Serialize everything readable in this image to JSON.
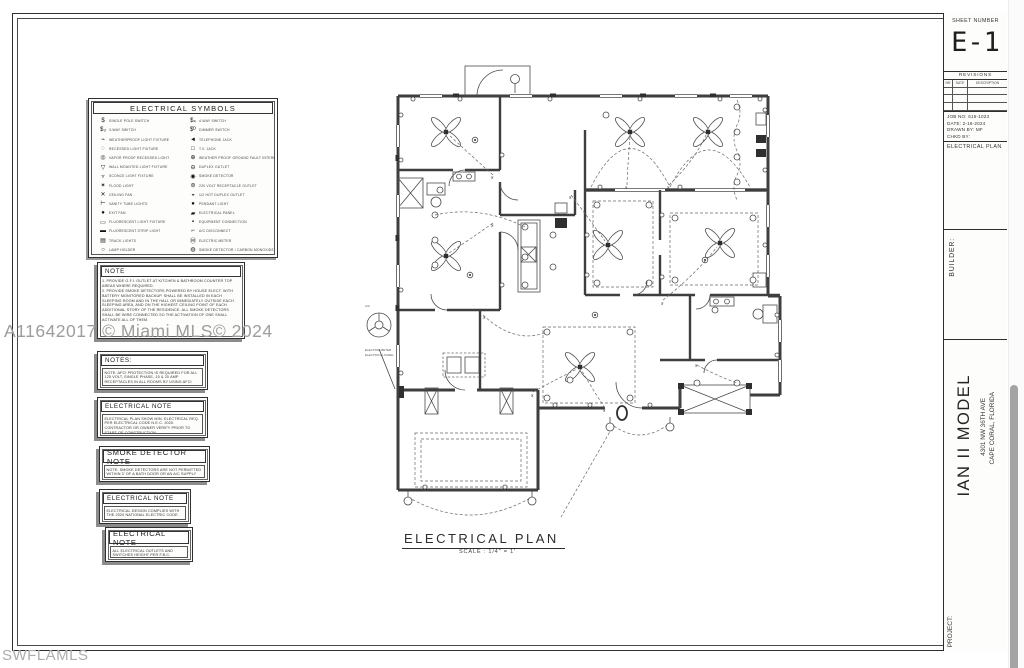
{
  "watermarks": {
    "mls_id": "A11642017 © Miami MLS© 2024",
    "swfl": "SWFLAMLS"
  },
  "legend": {
    "title": "ELECTRICAL SYMBOLS",
    "left": [
      {
        "glyph": "$",
        "label": "SINGLE POLE SWITCH"
      },
      {
        "glyph": "$₃",
        "label": "3-WAY SWITCH"
      },
      {
        "glyph": "⌁",
        "label": "WEATHERPROOF LIGHT FIXTURE"
      },
      {
        "glyph": "◌",
        "label": "RECESSED LIGHT FIXTURE"
      },
      {
        "glyph": "◎",
        "label": "VAPOR PROOF RECESSED LIGHT"
      },
      {
        "glyph": "▽",
        "label": "WALL MOUNTED LIGHT FIXTURE"
      },
      {
        "glyph": "▿",
        "label": "SCONCE LIGHT FIXTURE"
      },
      {
        "glyph": "✶",
        "label": "FLOOD LIGHT"
      },
      {
        "glyph": "✕",
        "label": "CEILING FAN"
      },
      {
        "glyph": "⊢",
        "label": "VANITY TUBE LIGHTS"
      },
      {
        "glyph": "●",
        "label": "EXIT FAN"
      },
      {
        "glyph": "▭",
        "label": "FLUORESCENT LIGHT FIXTURE"
      },
      {
        "glyph": "▬",
        "label": "FLUORESCENT STRIP LIGHT"
      },
      {
        "glyph": "▤",
        "label": "TRACK LIGHTS"
      },
      {
        "glyph": "○",
        "label": "LAMP HOLDER"
      }
    ],
    "right": [
      {
        "glyph": "$₄",
        "label": "4-WAY SWITCH"
      },
      {
        "glyph": "$ᴰ",
        "label": "DIMMER SWITCH"
      },
      {
        "glyph": "◄",
        "label": "TELEPHONE JACK"
      },
      {
        "glyph": "□",
        "label": "T.V. JACK"
      },
      {
        "glyph": "⊕",
        "label": "WEATHER PROOF GROUND FAULT INTERRUPT"
      },
      {
        "glyph": "⊖",
        "label": "DUPLEX OUTLET"
      },
      {
        "glyph": "◉",
        "label": "SMOKE DETECTOR"
      },
      {
        "glyph": "⊜",
        "label": "220 VOLT RECEPTACLE OUTLET"
      },
      {
        "glyph": "◒",
        "label": "1/2 HOT DUPLEX OUTLET"
      },
      {
        "glyph": "●",
        "label": "PENDANT LIGHT"
      },
      {
        "glyph": "▰",
        "label": "ELECTRICAL PANEL"
      },
      {
        "glyph": "▪",
        "label": "EQUIPMENT CONNECTION"
      },
      {
        "glyph": "⌐",
        "label": "A/C DISCONNECT"
      },
      {
        "glyph": "Ⓜ",
        "label": "ELECTRIC METER"
      },
      {
        "glyph": "◍",
        "label": "SMOKE DETECTOR / CARBON MONOXIDE COMBO"
      }
    ]
  },
  "notes": [
    {
      "title": "NOTE",
      "body": "1.  PROVIDE G.F.I. OUTLET AT KITCHEN & BATHROOM COUNTER TOP AREAS WHERE REQUIRED.\n2.  PROVIDE SMOKE DETECTORS POWERED BY HOUSE ELECT. WITH BATTERY MONITORED BACKUP. SHALL BE INSTALLED IN EACH SLEEPING ROOM AND IN THE HALL OR IMMEDIATELY OUTSIDE EACH SLEEPING AREA, AND ON THE HIGHEST CEILING POINT OF EACH ADDITIONAL STORY OF THE RESIDENCE. ALL SMOKE DETECTORS SHALL BE WIRE CONNECTED SO THE ACTIVATION OF ONE SHALL ACTIVATE ALL OF THEM."
    },
    {
      "title": "NOTES:",
      "body": "NOTE: AFCI PROTECTION IS REQUIRED FOR ALL 125 VOLT, SINGLE PHASE, 15 & 20 AMP RECEPTACLES IN ALL ROOMS BY USING AFCI CIRCUIT BREAKERS OR AFCI RECEPTACLES."
    },
    {
      "title": "ELECTRICAL NOTE",
      "body": "ELECTRICAL PLAN SHOW MIN. ELECTRICAL REQ. PER ELECTRICAL CODE N.E.C. 2020. CONTRACTOR OR OWNER VERIFY PRIOR TO START OF CONSTRUCTION."
    },
    {
      "title": "SMOKE DETECTOR NOTE",
      "body": "NOTE: SMOKE DETECTORS ARE NOT PERMITTED WITHIN 3' OF A BATH DOOR OR AN A/C SUPPLY OUTLET."
    },
    {
      "title": "ELECTRICAL NOTE",
      "body": "ELECTRICAL DESIGN COMPLIES WITH THE 2020 NATIONAL ELECTRIC CODE."
    },
    {
      "title": "ELECTRICAL NOTE",
      "body": "ALL ELECTRICAL OUTLETS AND SWITCHES HEIGHT PER F.B.C."
    }
  ],
  "plan": {
    "title": "ELECTRICAL PLAN",
    "scale": "SCALE : 1/4\" = 1'",
    "annotations": {
      "meter": "ELECTRIC METER",
      "panel": "ELECTRICAL PANEL",
      "ac": "A/C"
    }
  },
  "titleblock": {
    "sheet_number_label": "SHEET NUMBER",
    "sheet_number": "E-1",
    "revisions_label": "REVISIONS",
    "revision_columns": [
      "NR",
      "DATE",
      "DESCRIPTION"
    ],
    "job_no": "JOB NO: 615-1023",
    "date": "DATE: 2-16-2024",
    "drawn_by": "DRAWN BY: MF",
    "chkd_by": "CHKD BY:",
    "sheet_title": "ELECTRICAL PLAN",
    "builder_label": "BUILDER:",
    "project_label": "PROJECT:",
    "project_name": "IAN II MODEL",
    "project_address1": "4301 NW 36TH AVE",
    "project_address2": "CAPE CORAL, FLORIDA"
  }
}
